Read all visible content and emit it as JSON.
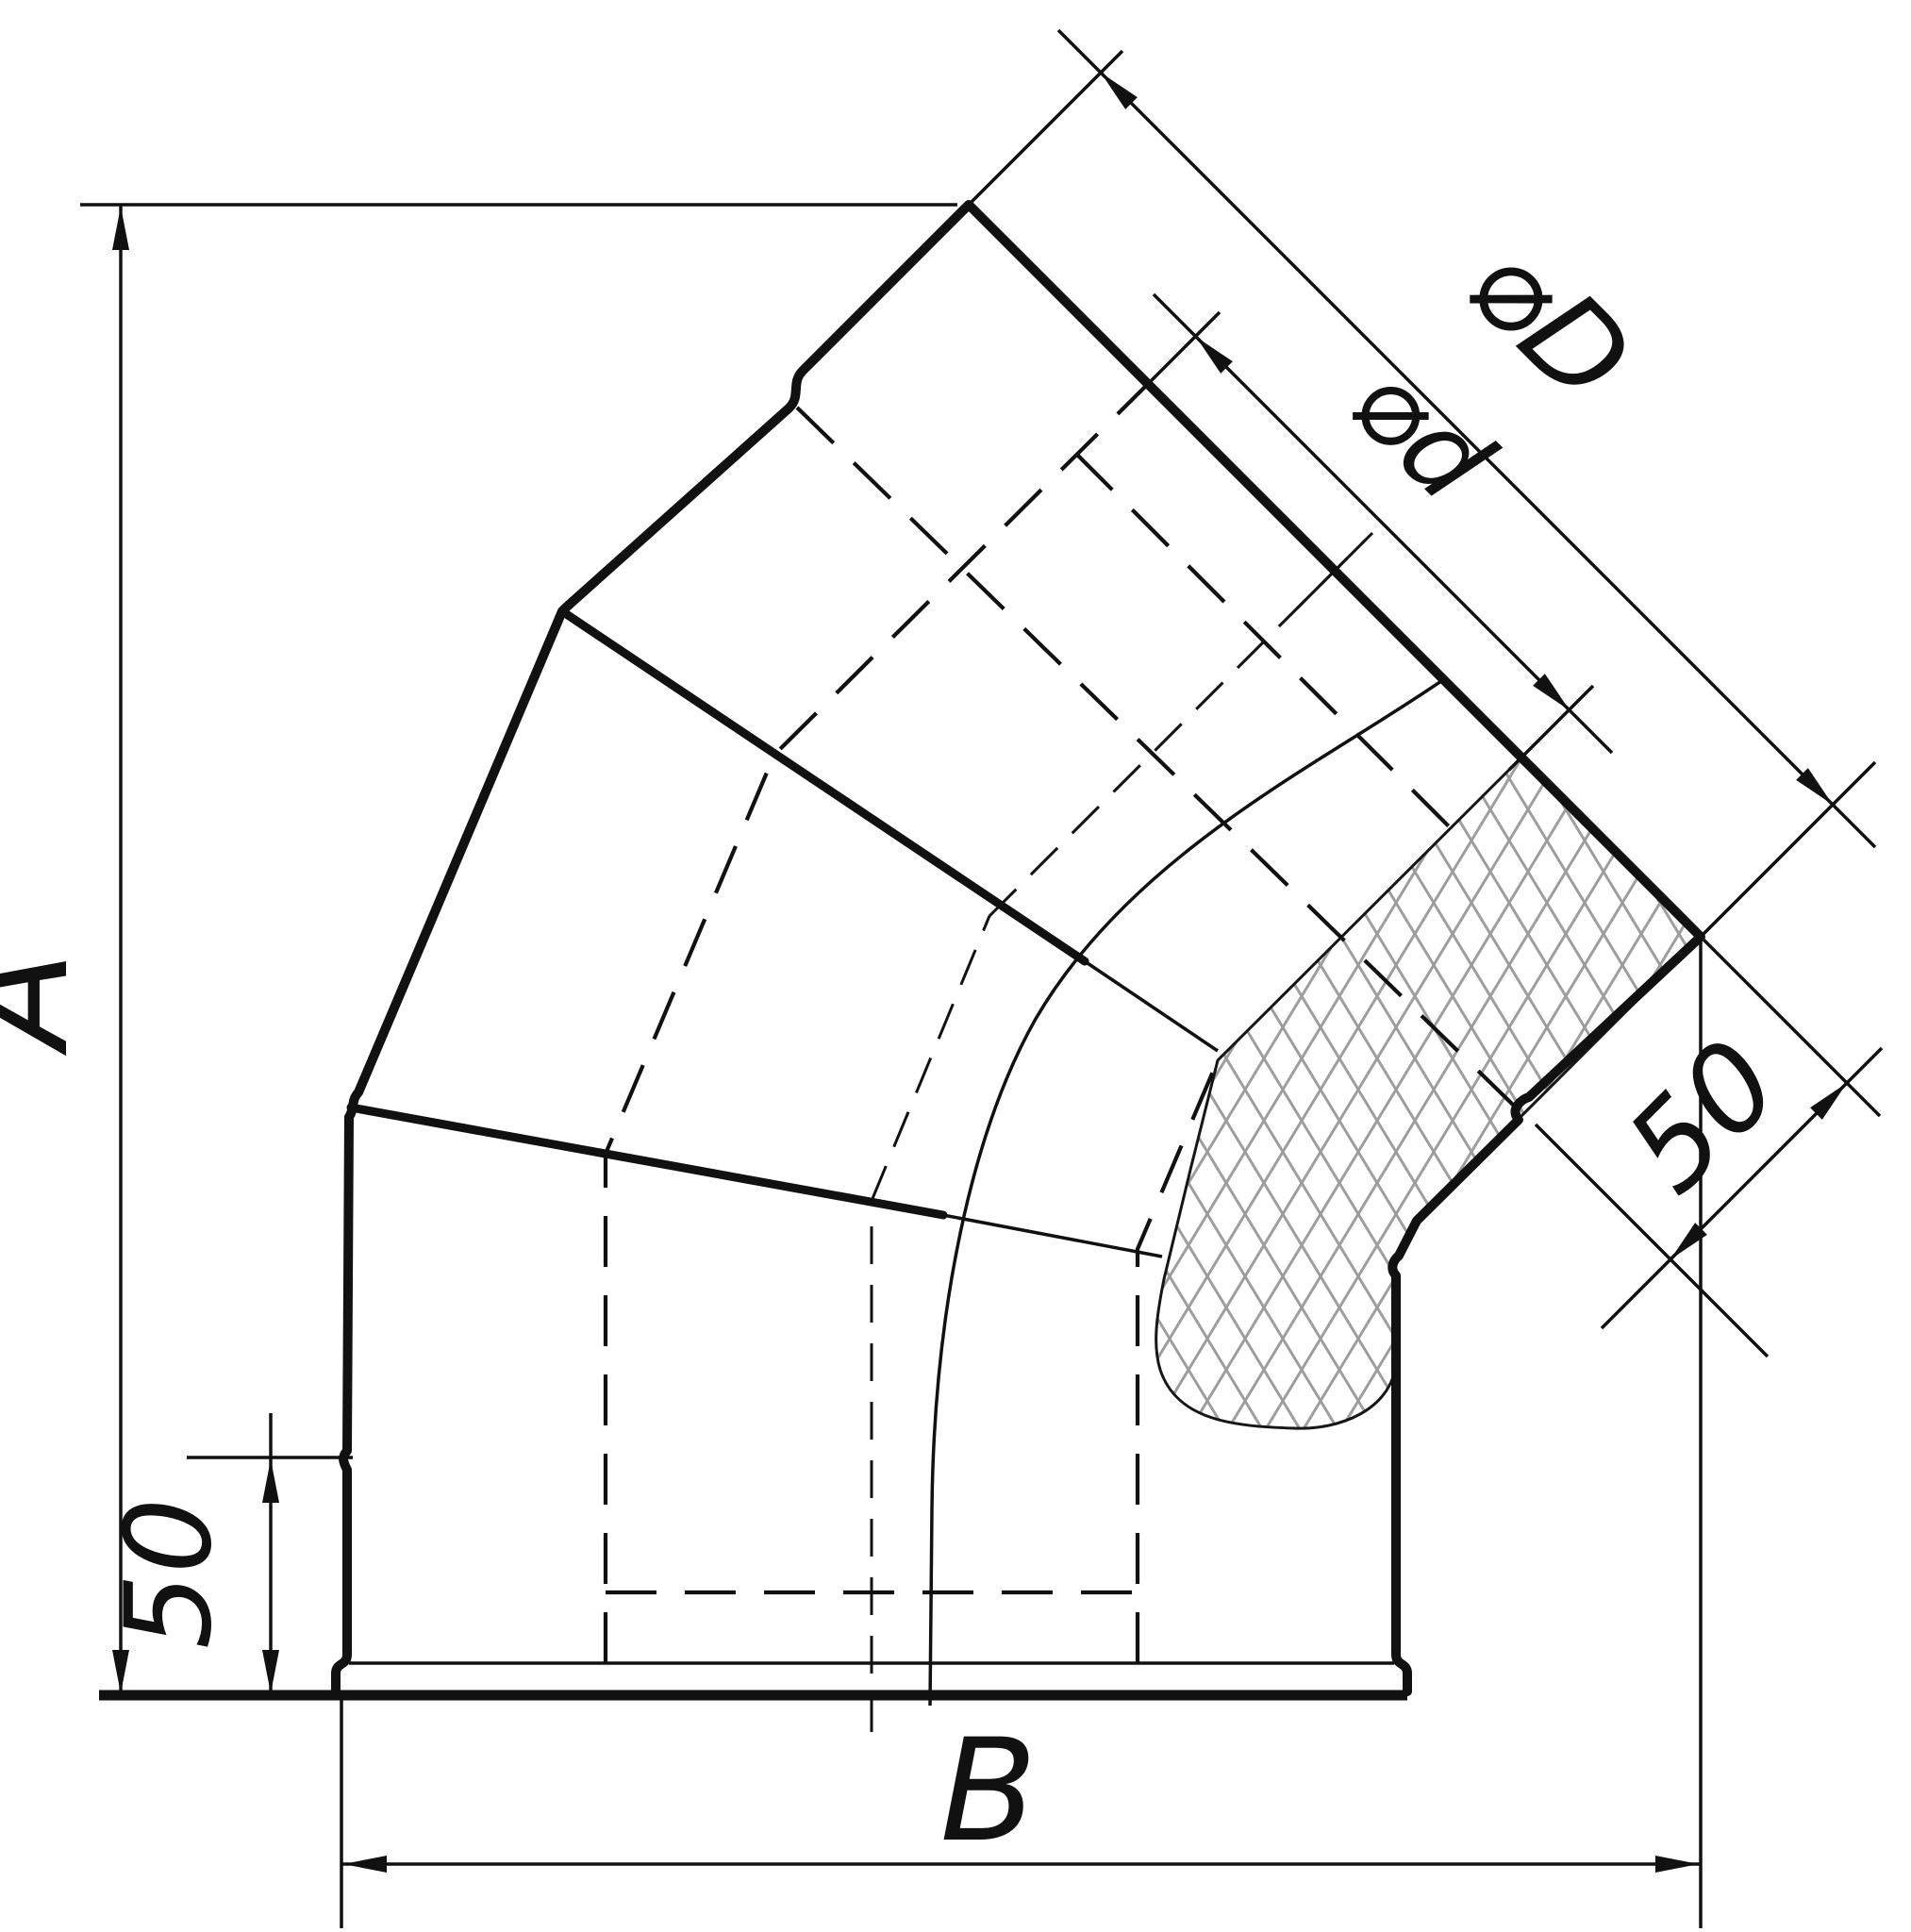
{
  "drawing": {
    "kind": "technical dimension drawing",
    "subject": "45-degree insulated sandwich flue elbow, sectional cutaway with insulation hatch",
    "background": "#ffffff",
    "line_color": "#111111",
    "hatch_color": "#9e9e9e"
  },
  "labels": {
    "dim_height": "A",
    "dim_width": "B",
    "dim_socket_bottom": "50",
    "dim_socket_top": "50",
    "dim_inner_diameter": "⌀d",
    "dim_outer_diameter": "⌀D"
  }
}
